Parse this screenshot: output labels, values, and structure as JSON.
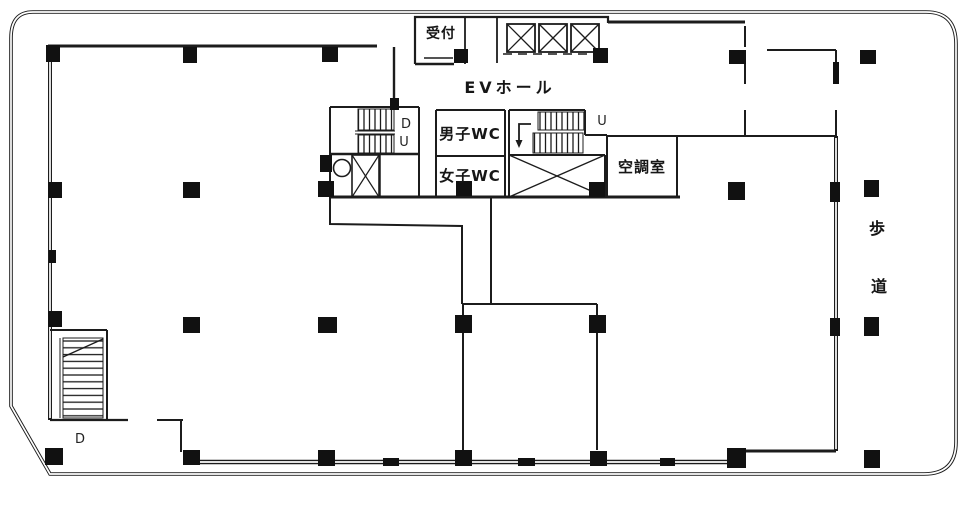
{
  "plan": {
    "title": "building-floor-plan",
    "rooms": {
      "reception": {
        "label": "受付"
      },
      "mens_wc": {
        "label": "男子WC"
      },
      "womens_wc": {
        "label": "女子WC"
      },
      "ac_room": {
        "label": "空調室"
      }
    },
    "areas": {
      "ev_hall": {
        "label": "EVホール"
      },
      "sidewalk": {
        "label": "歩道",
        "chars": {
          "first": "歩",
          "second": "道"
        }
      }
    },
    "stairs": {
      "southwest": {
        "down_label": "D"
      },
      "core_left": {
        "down_label": "D",
        "up_label": "U"
      },
      "core_right": {
        "up_label": "U"
      }
    },
    "colors": {
      "line": "#1c1c1c",
      "column_fill": "#111111",
      "background": "#ffffff"
    }
  }
}
